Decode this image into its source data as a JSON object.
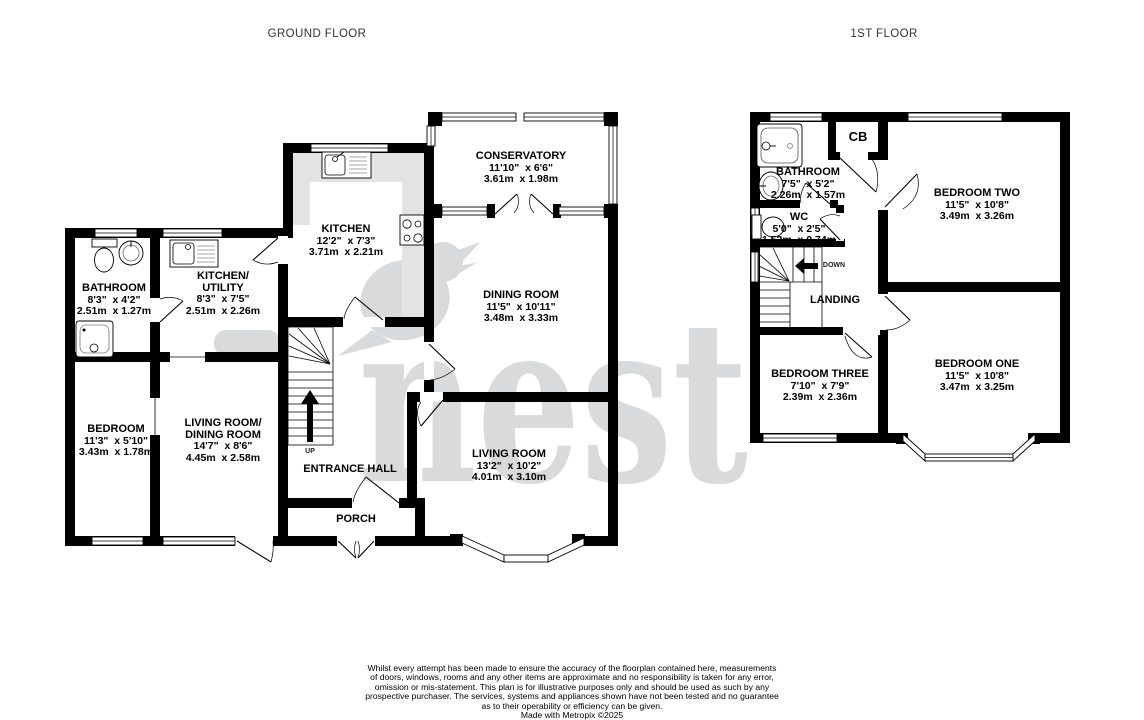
{
  "floors": {
    "ground": {
      "title": "GROUND FLOOR",
      "rooms": {
        "bathroom": {
          "name": "BATHROOM",
          "imperial": "8'3\"  x 4'2\"",
          "metric": "2.51m  x 1.27m"
        },
        "kitchen_utility": {
          "name": "KITCHEN/\nUTILITY",
          "imperial": "8'3\"  x 7'5\"",
          "metric": "2.51m  x 2.26m"
        },
        "kitchen": {
          "name": "KITCHEN",
          "imperial": "12'2\"  x 7'3\"",
          "metric": "3.71m  x 2.21m"
        },
        "conservatory": {
          "name": "CONSERVATORY",
          "imperial": "11'10\"  x 6'6\"",
          "metric": "3.61m  x 1.98m"
        },
        "dining_room": {
          "name": "DINING ROOM",
          "imperial": "11'5\"  x 10'11\"",
          "metric": "3.48m  x 3.33m"
        },
        "bedroom": {
          "name": "BEDROOM",
          "imperial": "11'3\"  x 5'10\"",
          "metric": "3.43m  x 1.78m"
        },
        "living_dining": {
          "name": "LIVING ROOM/\nDINING ROOM",
          "imperial": "14'7\"  x 8'6\"",
          "metric": "4.45m  x 2.58m"
        },
        "living_room": {
          "name": "LIVING ROOM",
          "imperial": "13'2\"  x 10'2\"",
          "metric": "4.01m  x 3.10m"
        },
        "entrance_hall": {
          "name": "ENTRANCE HALL"
        },
        "porch": {
          "name": "PORCH"
        },
        "stair_direction": "UP"
      }
    },
    "first": {
      "title": "1ST FLOOR",
      "rooms": {
        "bathroom": {
          "name": "BATHROOM",
          "imperial": "7'5\"  x 5'2\"",
          "metric": "2.26m  x 1.57m"
        },
        "cupboard": {
          "name": "CB"
        },
        "wc": {
          "name": "WC",
          "imperial": "5'0\"  x 2'5\"",
          "metric": "1.52m  x 0.74m"
        },
        "landing": {
          "name": "LANDING"
        },
        "bedroom_two": {
          "name": "BEDROOM TWO",
          "imperial": "11'5\"  x 10'8\"",
          "metric": "3.49m  x 3.26m"
        },
        "bedroom_three": {
          "name": "BEDROOM THREE",
          "imperial": "7'10\"  x 7'9\"",
          "metric": "2.39m  x 2.36m"
        },
        "bedroom_one": {
          "name": "BEDROOM ONE",
          "imperial": "11'5\"  x 10'8\"",
          "metric": "3.47m  x 3.25m"
        },
        "stair_direction": "DOWN"
      }
    }
  },
  "watermark": {
    "text": "nest",
    "color": "#d9dadb",
    "icon": "bird-silhouette"
  },
  "footer": {
    "lines": [
      "Whilst every attempt has been made to ensure the accuracy of the floorplan contained here, measurements",
      "of doors, windows, rooms and any other items are approximate and no responsibility is taken for any error,",
      "omission or mis-statement. This plan is for illustrative purposes only and should be used as such by any",
      "prospective purchaser. The services, systems and appliances shown have not been tested and no guarantee",
      "as to their operability or efficiency can be given.",
      "Made with Metropix ©2025"
    ]
  }
}
